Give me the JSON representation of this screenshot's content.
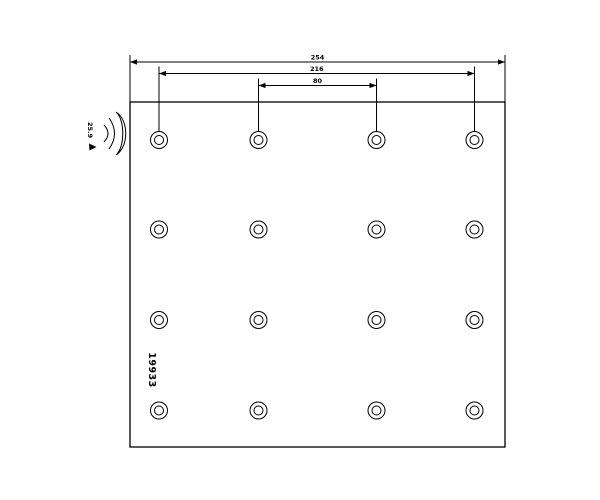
{
  "page": {
    "background_color": "#ffffff",
    "line_color": "#000000"
  },
  "drawing": {
    "type": "brake-lining-technical-drawing",
    "part_number": "19933",
    "thickness_label": "25.9",
    "dimensions": [
      {
        "name": "overall-width",
        "label": "254",
        "x1": 130,
        "x2": 505,
        "y": 62
      },
      {
        "name": "outer-hole-spacing",
        "label": "216",
        "x1": 159,
        "x2": 474.5,
        "y": 73.5
      },
      {
        "name": "inner-hole-spacing",
        "label": "80",
        "x1": 258.5,
        "x2": 376.5,
        "y": 85.5
      }
    ],
    "plate": {
      "x": 130,
      "y": 102,
      "width": 375,
      "height": 345
    },
    "holes": {
      "columns_x": [
        159,
        258.5,
        376.5,
        474.5
      ],
      "rows_y": [
        140,
        229.5,
        320,
        410.5
      ],
      "outer_radius": 8.5,
      "inner_radius": 4.5
    }
  }
}
